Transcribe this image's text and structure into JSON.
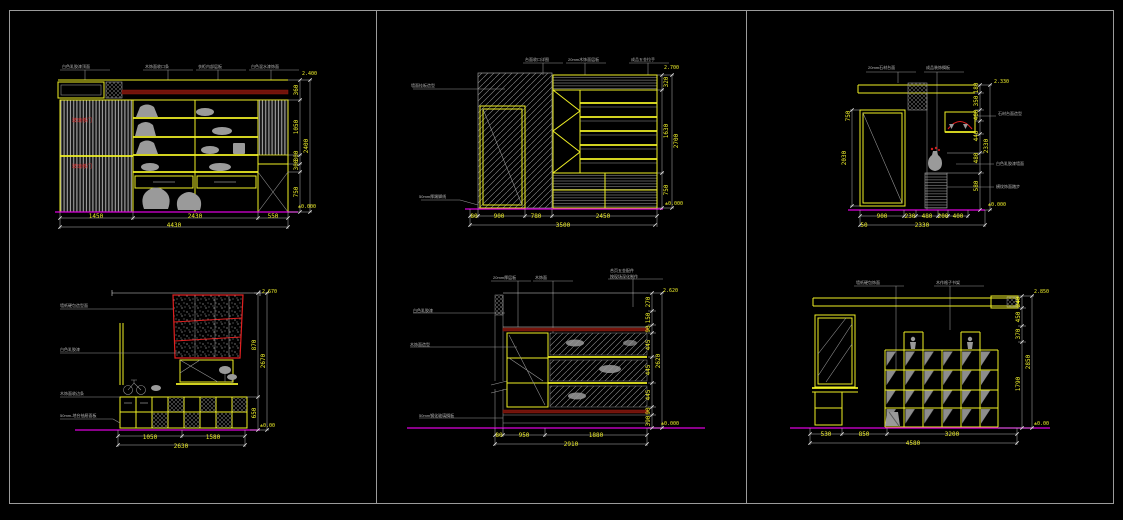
{
  "colors": {
    "background": "#000000",
    "linework_yellow": "#efef25",
    "dim_text": "#ecec2a",
    "annotation_gray": "#b9b9b9",
    "floor_magenta": "#dc00dc",
    "accent_red": "#e02020",
    "band_dark_red": "#71130b",
    "frame_gray": "#9b9b9b"
  },
  "p1": {
    "top_labels": [
      "白色乳胶漆顶面",
      "木饰面收口条",
      "衣柜内部层板",
      "白色混水漆饰面"
    ],
    "red_label1": "玻璃移门",
    "red_label2": "玻璃移门",
    "bottom_dims": [
      "1450",
      "2430",
      "550"
    ],
    "bottom_total": "4430",
    "side_dims": [
      "360",
      "1050",
      "300",
      "300",
      "750"
    ],
    "side_total": "2400",
    "elev_top": "2.400",
    "elev_bottom": "±0.000"
  },
  "p2": {
    "top_labels": [
      "台面收口详图",
      "20mm木饰面层板",
      "成品五金拉手"
    ],
    "left_label": "墙面挂板造型",
    "bottom_left_label": "50mm厚踢脚线",
    "bottom_dims": [
      "80",
      "900",
      "780",
      "2450"
    ],
    "bottom_total": "3500",
    "side_dims": [
      "320",
      "1630",
      "750"
    ],
    "side_total": "2700",
    "elev_top": "2.700",
    "elev_bottom": "±0.000"
  },
  "p3": {
    "top_labels": [
      "20mm石材台面",
      "成品装饰搁板"
    ],
    "right_labels": [
      "石材台面造型",
      "白色乳胶漆墙面",
      "横纹饰面踏步"
    ],
    "left_dim": "750",
    "left_dim2": "2030",
    "bottom_dims": [
      "900",
      "230",
      "480",
      "200",
      "400"
    ],
    "bottom_sub": "50",
    "bottom_total": "2330",
    "side_dims": [
      "180",
      "350",
      "460",
      "440",
      "480",
      "580"
    ],
    "side_total": "2330",
    "elev_top": "2.330",
    "elev_bottom": "±0.000"
  },
  "p4": {
    "left_labels": [
      "墙纸硬包造型面",
      "白色乳胶漆",
      "木饰面收边条",
      "50mm-地台抽屉面板"
    ],
    "bottom_dims": [
      "1050",
      "1580"
    ],
    "bottom_total": "2630",
    "side_dims": [
      "870",
      "650"
    ],
    "side_total": "2670",
    "elev_top": "2.670",
    "elev_bottom": "±0.00"
  },
  "p5": {
    "top_labels": [
      "20mm厚层板",
      "木饰面",
      "合页五金配件",
      "按现场深化制作"
    ],
    "left_labels": [
      "白色乳胶漆",
      "木饰面造型",
      "50mm钢化玻璃搁板"
    ],
    "bottom_dims": [
      "80",
      "950",
      "1880"
    ],
    "bottom_total": "2910",
    "side_dims": [
      "270",
      "150",
      "90",
      "445",
      "445",
      "445",
      "90",
      "390"
    ],
    "side_total": "2620",
    "elev_top": "2.620",
    "elev_bottom": "±0.000"
  },
  "p6": {
    "top_labels": [
      "墙纸硬包饰面",
      "木作格子书架"
    ],
    "bottom_dims": [
      "530",
      "850",
      "3200"
    ],
    "bottom_total": "4580",
    "side_dims": [
      "240",
      "450",
      "370",
      "1790"
    ],
    "side_total": "2850",
    "elev_top": "2.850",
    "elev_bottom": "±0.00"
  }
}
